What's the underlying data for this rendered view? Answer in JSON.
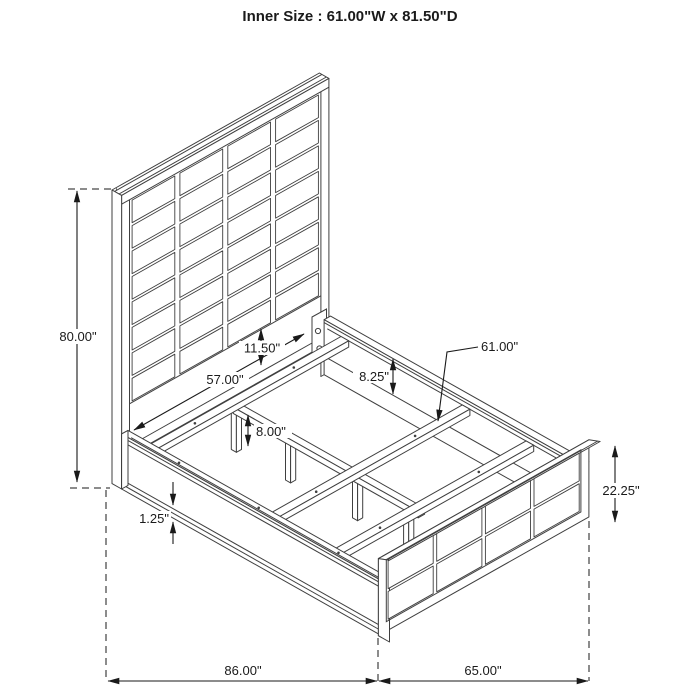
{
  "title": "Inner Size : 61.00\"W x 81.50\"D",
  "diagram": {
    "type": "isometric bed frame dimension drawing",
    "line_color": "#3f3f3f",
    "dimension_color": "#1a1a1a",
    "background": "#ffffff"
  },
  "dims": {
    "headboard_height": "80.00\"",
    "rail_inner_length": "57.00\"",
    "headboard_rail_gap": "11.50\"",
    "side_rail_depth": "8.25\"",
    "slat_length": "61.00\"",
    "leg_height": "8.00\"",
    "rail_trim": "1.25\"",
    "footboard_height": "22.25\"",
    "overall_length": "86.00\"",
    "footboard_width": "65.00\""
  }
}
